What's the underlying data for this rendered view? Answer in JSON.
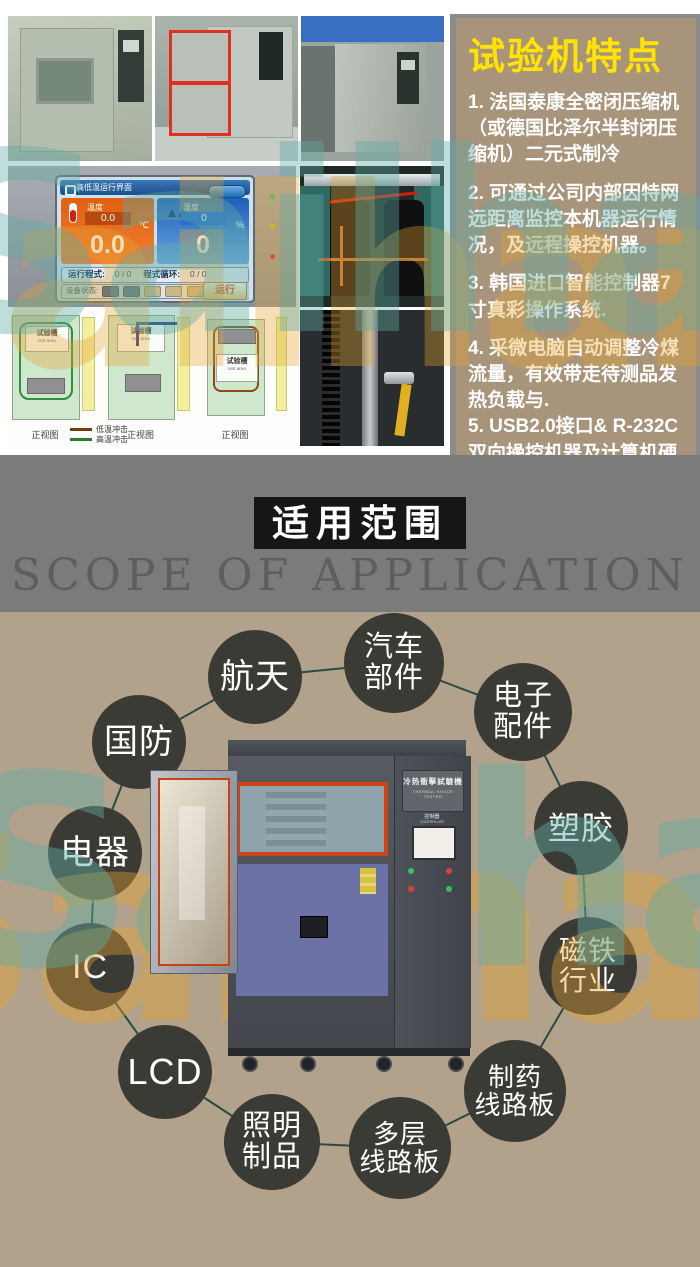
{
  "watermark": {
    "text": "Sailham",
    "teal": "#5faaa2",
    "orange": "#e4a232"
  },
  "features_panel": {
    "title": "试验机特点",
    "items": [
      "1. 法国泰康全密闭压缩机（或德国比泽尔半封闭压缩机）二元式制冷",
      "2. 可通过公司内部因特网远距离监控本机器运行情况，及远程操控机器。",
      "3. 韩国进口智能控制器7寸真彩操作系统.",
      "4. 采微电脑自动调整冷煤流量，有效带走待测品发热负载与.",
      "5. USB2.0接口& R-232C双向操控机器及计算机硬盘储存数据."
    ]
  },
  "screen_ui": {
    "title": "高低温运行界面",
    "temperature": {
      "label": "温度",
      "set_value": "0.0",
      "value": "0.0",
      "unit": "℃"
    },
    "humidity": {
      "label": "湿度",
      "set_value": "0",
      "value": "0",
      "unit": "%"
    },
    "program_label": "运行程式:",
    "program_value": "0 / 0",
    "cycle_label": "程式循环:",
    "cycle_value": "0 / 0",
    "status_label": "设备状态:",
    "run_button": "运行"
  },
  "diagram": {
    "captions": [
      "正视图",
      "正视图",
      "正视图"
    ],
    "chamber_label": "试验槽",
    "chamber_sublabel": "test area",
    "legend": [
      {
        "label": "低温冲击",
        "color": "#7a3a10"
      },
      {
        "label": "高温冲击",
        "color": "#2e7a2e"
      }
    ]
  },
  "scope_section": {
    "title_cn": "适用范围",
    "title_en": "SCOPE OF APPLICATION"
  },
  "machine": {
    "label_cn": "冷热衝擊試驗機",
    "label_en": "THERMAL SHOCK TESTER",
    "panel_small_cn": "控制器",
    "panel_small_en": "CONTROLLER"
  },
  "applications": [
    {
      "lines": [
        "航天"
      ]
    },
    {
      "lines": [
        "汽车",
        "部件"
      ]
    },
    {
      "lines": [
        "电子",
        "配件"
      ]
    },
    {
      "lines": [
        "国防"
      ]
    },
    {
      "lines": [
        "塑胶"
      ]
    },
    {
      "lines": [
        "电器"
      ]
    },
    {
      "lines": [
        "磁铁",
        "行业"
      ]
    },
    {
      "lines": [
        "IC"
      ]
    },
    {
      "lines": [
        "制药",
        "线路板"
      ]
    },
    {
      "lines": [
        "LCD"
      ]
    },
    {
      "lines": [
        "照明",
        "制品"
      ]
    },
    {
      "lines": [
        "多层",
        "线路板"
      ]
    }
  ],
  "colors": {
    "features_panel_bg": "#a8947a",
    "features_title": "#ffe400",
    "beige_bg": "#b2a28b",
    "gray_band": "#7b7b7b",
    "scope_box": "#161616",
    "bubble_bg": "#3b3b36",
    "connector_line": "#2a4a42",
    "hmi_temp_orange": "#e06010",
    "hmi_humidity_blue": "#2a70cc",
    "door_gasket_red": "#cc4418"
  }
}
